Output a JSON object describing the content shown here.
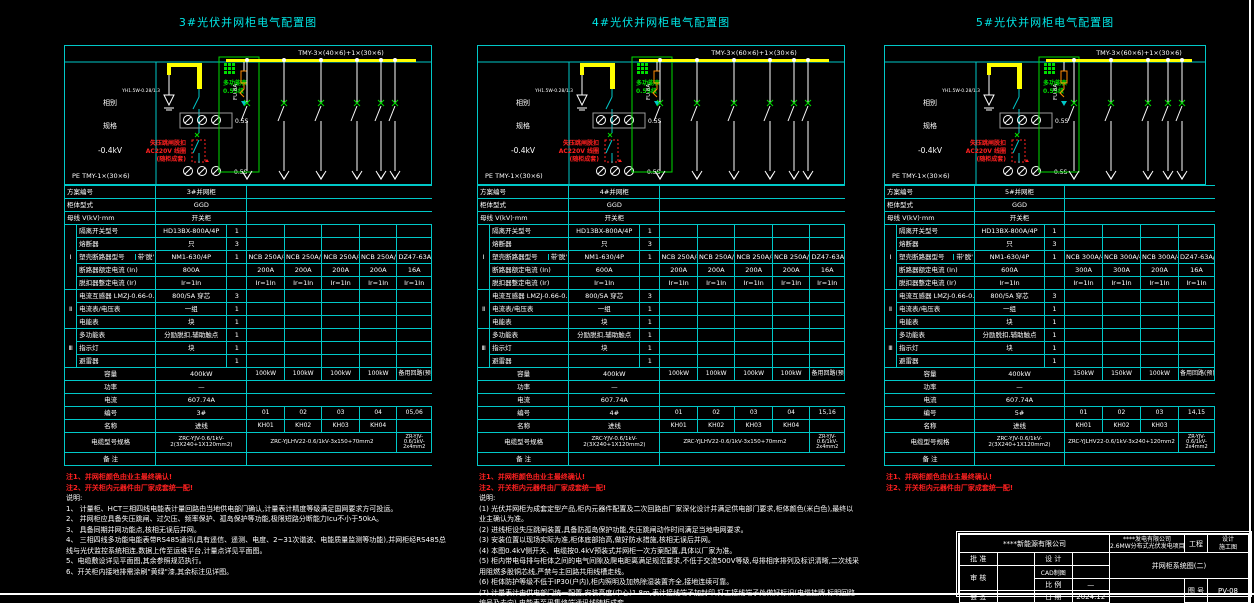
{
  "colors": {
    "cyan": "#00c8c8",
    "white": "#ffffff",
    "yellow": "#ffff00",
    "green": "#00dd00",
    "red": "#ff2020",
    "orange": "#ff8800"
  },
  "panels": [
    {
      "title": "3#光伏并网柜电气配置图",
      "layout": {
        "left": 64,
        "top": 14,
        "width": 368,
        "feeders": 5
      },
      "schematic": {
        "busbar_label": "TMY-3×(40×6)+1×(30×6)",
        "left_label_1": "相别",
        "left_label_2": "规格",
        "voltage_label": "-0.4kV",
        "pe_label": "PE  TMY-1×(30×6)",
        "arrester_label": "YH1.5W-0.28/1.3",
        "meter_class": "0.5S",
        "fuse_label": "FU 8A",
        "green_lines": [
          "多功能表",
          "0.5S级"
        ],
        "red_lines": [
          "失压跳闸脱扣",
          "AC220V 线圈",
          "(随柜成套)"
        ],
        "feeder_xs": [
          183,
          220,
          257,
          293,
          317,
          331
        ],
        "busbar_end": 352
      },
      "header_rows": [
        [
          "方案编号",
          "3#并网柜"
        ],
        [
          "柜体型式",
          "GGD"
        ],
        [
          "母线  V(kV)·mm",
          "开关柜"
        ]
      ],
      "rows": [
        {
          "group": "Ⅰ",
          "span": 5,
          "label": "隔离开关型号",
          "value": "HD13BX-800A/4P",
          "qty": "1",
          "feeders": [
            "",
            "",
            "",
            "",
            ""
          ]
        },
        {
          "label": "熔断器",
          "value": "只",
          "qty": "3",
          "feeders": [
            "",
            "",
            "",
            "",
            ""
          ]
        },
        {
          "label": "塑壳断路器型号",
          "sub": "带'脱'",
          "value": "NM1-630/4P",
          "qty": "1",
          "feeders": [
            "NCB 250A/4P",
            "NCB 250A/4P",
            "NCB 250A/4P",
            "NCB 250A/4P",
            "DZ47-63A/3P"
          ]
        },
        {
          "label": "断路器额定电流 (In)",
          "value": "800A",
          "qty": "",
          "feeders": [
            "200A",
            "200A",
            "200A",
            "200A",
            "16A"
          ]
        },
        {
          "label": "脱扣器整定电流 (Ir)",
          "value": "Ir=1In",
          "qty": "",
          "feeders": [
            "Ir=1In",
            "Ir=1In",
            "Ir=1In",
            "Ir=1In",
            "Ir=1In"
          ]
        },
        {
          "group": "Ⅱ",
          "span": 3,
          "label": "电流互感器  LMZJ-0.66-0.5级",
          "value": "800/5A 穿芯",
          "qty": "3",
          "feeders": [
            "",
            "",
            "",
            "",
            ""
          ]
        },
        {
          "label": "电流表/电压表",
          "value": "一组",
          "qty": "1",
          "feeders": [
            "",
            "",
            "",
            "",
            ""
          ]
        },
        {
          "label": "电能表",
          "value": "块",
          "qty": "1",
          "feeders": [
            "",
            "",
            "",
            "",
            ""
          ]
        },
        {
          "group": "Ⅲ",
          "span": 3,
          "label": "多功能表",
          "value": "分励脱扣,辅助触点",
          "qty": "1",
          "feeders": [
            "",
            "",
            "",
            "",
            ""
          ]
        },
        {
          "label": "指示灯",
          "value": "块",
          "qty": "1",
          "feeders": [
            "",
            "",
            "",
            "",
            ""
          ]
        },
        {
          "label": "避雷器",
          "value": "",
          "qty": "1",
          "feeders": [
            "",
            "",
            "",
            "",
            ""
          ]
        }
      ],
      "summary": {
        "capacity": {
          "label": "容量",
          "value": "400kW",
          "feeders": [
            "100kW",
            "100kW",
            "100kW",
            "100kW",
            "备用回路(预留)"
          ]
        },
        "comp": {
          "label": "功率",
          "value": "—"
        },
        "current": {
          "label": "电流",
          "value": "607.74A"
        },
        "circuit_no": {
          "label": "编号",
          "value": "3#",
          "feeders": [
            "01",
            "02",
            "03",
            "04",
            "05,06"
          ]
        },
        "circuit_name": {
          "label": "名称",
          "value": "进线",
          "feeders": [
            "KH01",
            "KH02",
            "KH03",
            "KH04",
            ""
          ]
        },
        "cable": {
          "label": "电缆型号规格",
          "value": "ZRC-YJV-0.6/1kV-2(3X240+1X120mm2)",
          "span": "ZRC-YJLHV22-0.6/1kV-3x150+70mm2",
          "last": "ZR-YJV-0.6/1kV-2x4mm2"
        },
        "remark": {
          "label": "备 注"
        }
      },
      "notes_red": [
        "注1、并网柜颜色由业主最终确认!",
        "注2、开关柜内元器件由厂家成套统一配!"
      ],
      "notes_title": "说明:",
      "notes": [
        "1、 计量柜、HCT三相四线电能表计量回路由当地供电部门确认,计量表计精度等级满足国网要求方可投运。",
        "2、 并网柜应具备失压跳闸、过欠压、频率保护、孤岛保护等功能,极限短路分断能力Icu不小于50kA。",
        "3、 具备同期并网功能点,核相无误后并网。",
        "4、 三相四线多功能电能表带RS485通讯(具有遥信、遥测、电度、2~31次谐波、电能质量监测等功能),并网柜经RS485总线与光伏监控系统相连,数据上传至运维平台,计量点详见平面图。",
        "5、电缆敷设详见平面图,其余参照规范执行。",
        "6、开关柜内接地排需涂刷\"黄绿\"漆,其余标注见详图。"
      ]
    },
    {
      "title": "4#光伏并网柜电气配置图",
      "layout": {
        "left": 477,
        "top": 14,
        "width": 368,
        "feeders": 5
      },
      "schematic": {
        "busbar_label": "TMY-3×(60×6)+1×(30×6)",
        "left_label_1": "相别",
        "left_label_2": "规格",
        "voltage_label": "-0.4kV",
        "pe_label": "PE  TMY-1×(30×6)",
        "arrester_label": "YH1.5W-0.28/1.3",
        "meter_class": "0.5S",
        "fuse_label": "FU 8A",
        "green_lines": [
          "多功能表",
          "0.5S级"
        ],
        "red_lines": [
          "失压跳闸脱扣",
          "AC220V 线圈",
          "(随柜成套)"
        ],
        "feeder_xs": [
          183,
          220,
          257,
          293,
          317,
          331
        ],
        "busbar_end": 352
      },
      "header_rows": [
        [
          "方案编号",
          "4#并网柜"
        ],
        [
          "柜体型式",
          "GGD"
        ],
        [
          "母线  V(kV)·mm",
          "开关柜"
        ]
      ],
      "rows": [
        {
          "group": "Ⅰ",
          "span": 5,
          "label": "隔离开关型号",
          "value": "HD13BX-800A/4P",
          "qty": "1",
          "feeders": [
            "",
            "",
            "",
            "",
            ""
          ]
        },
        {
          "label": "熔断器",
          "value": "只",
          "qty": "3",
          "feeders": [
            "",
            "",
            "",
            "",
            ""
          ]
        },
        {
          "label": "塑壳断路器型号",
          "sub": "带'脱'",
          "value": "NM1-630/4P",
          "qty": "1",
          "feeders": [
            "NCB 250A/4P",
            "NCB 250A/4P",
            "NCB 250A/4P",
            "NCB 250A/4P",
            "DZ47-63A/3P"
          ]
        },
        {
          "label": "断路器额定电流 (In)",
          "value": "600A",
          "qty": "",
          "feeders": [
            "200A",
            "200A",
            "200A",
            "200A",
            "16A"
          ]
        },
        {
          "label": "脱扣器整定电流 (Ir)",
          "value": "Ir=1In",
          "qty": "",
          "feeders": [
            "Ir=1In",
            "Ir=1In",
            "Ir=1In",
            "Ir=1In",
            "Ir=1In"
          ]
        },
        {
          "group": "Ⅱ",
          "span": 3,
          "label": "电流互感器  LMZJ-0.66-0.5级",
          "value": "800/5A 穿芯",
          "qty": "3",
          "feeders": [
            "",
            "",
            "",
            "",
            ""
          ]
        },
        {
          "label": "电流表/电压表",
          "value": "一组",
          "qty": "1",
          "feeders": [
            "",
            "",
            "",
            "",
            ""
          ]
        },
        {
          "label": "电能表",
          "value": "块",
          "qty": "1",
          "feeders": [
            "",
            "",
            "",
            "",
            ""
          ]
        },
        {
          "group": "Ⅲ",
          "span": 3,
          "label": "多功能表",
          "value": "分励脱扣,辅助触点",
          "qty": "1",
          "feeders": [
            "",
            "",
            "",
            "",
            ""
          ]
        },
        {
          "label": "指示灯",
          "value": "块",
          "qty": "1",
          "feeders": [
            "",
            "",
            "",
            "",
            ""
          ]
        },
        {
          "label": "避雷器",
          "value": "",
          "qty": "1",
          "feeders": [
            "",
            "",
            "",
            "",
            ""
          ]
        }
      ],
      "summary": {
        "capacity": {
          "label": "容量",
          "value": "400kW",
          "feeders": [
            "100kW",
            "100kW",
            "100kW",
            "100kW",
            "备用回路(预留)"
          ]
        },
        "comp": {
          "label": "功率",
          "value": "—"
        },
        "current": {
          "label": "电流",
          "value": "607.74A"
        },
        "circuit_no": {
          "label": "编号",
          "value": "4#",
          "feeders": [
            "01",
            "02",
            "03",
            "04",
            "15,16"
          ]
        },
        "circuit_name": {
          "label": "名称",
          "value": "进线",
          "feeders": [
            "KH01",
            "KH02",
            "KH03",
            "KH04",
            ""
          ]
        },
        "cable": {
          "label": "电缆型号规格",
          "value": "ZRC-YJV-0.6/1kV-2(3X240+1X120mm2)",
          "span": "ZRC-YJLHV22-0.6/1kV-3x150+70mm2",
          "last": "ZR-YJV-0.6/1kV-2x4mm2"
        },
        "remark": {
          "label": "备 注"
        }
      },
      "notes_red": [
        "注1、并网柜颜色由业主最终确认!",
        "注2、开关柜内元器件由厂家成套统一配!"
      ],
      "notes_title": "说明:",
      "notes": [
        "(1) 光伏并网柜为成套定型产品,柜内元器件配置及二次回路由厂家深化设计并满足供电部门要求,柜体颜色(米白色),最终以业主确认为准。",
        "(2) 进线柜设失压跳闸装置,具备防孤岛保护功能,失压跳闸动作时间满足当地电网要求。",
        "(3) 安装位置以现场实际为准,柜体底部抬高,做好防水措施,核相无误后并网。",
        "(4) 本图0.4kV侧开关、电缆按0.4kV预装式并网柜一次方案配置,具体以厂家为准。",
        "(5) 柜内带电母排与柜体之间的电气间隙及爬电距离满足规范要求,不低于交流500V等级,母排相序排列及标识清晰,二次线采用阻燃多股铜芯线,严禁与主回路共用线槽走线。",
        "(6) 柜体防护等级不低于IP30(户内),柜内照明及加热除湿装置齐全,接地连续可靠。",
        "(7) 计量表计由供电部门统一配置,安装高度(中心)1.8m,表计接线端子加封印,打工接线端子处做好标识(电缆挂牌,标明回路编号及去向),电能表至采集终端通讯线随柜成套。",
        "(8) 本图母排选用0.4kV铜母线TMY(规格见图),接至配电室低压0.4kV系统图,编号统一。"
      ]
    },
    {
      "title": "5#光伏并网柜电气配置图",
      "layout": {
        "left": 884,
        "top": 14,
        "width": 322,
        "feeders": 4
      },
      "schematic": {
        "busbar_label": "TMY-3×(60×6)+1×(30×6)",
        "left_label_1": "相别",
        "left_label_2": "规格",
        "voltage_label": "-0.4kV",
        "pe_label": "PE  TMY-1×(30×6)",
        "arrester_label": "YH1.5W-0.28/1.3",
        "meter_class": "0.5S",
        "fuse_label": "FU 8A",
        "green_lines": [
          "多功能表",
          "0.5S级"
        ],
        "red_lines": [
          "失压跳闸脱扣",
          "AC220V 线圈",
          "(随柜成套)"
        ],
        "feeder_xs": [
          190,
          227,
          264,
          284,
          298
        ],
        "busbar_end": 308
      },
      "header_rows": [
        [
          "方案编号",
          "5#并网柜"
        ],
        [
          "柜体型式",
          "GGD"
        ],
        [
          "母线  V(kV)·mm",
          "开关柜"
        ]
      ],
      "rows": [
        {
          "group": "Ⅰ",
          "span": 5,
          "label": "隔离开关型号",
          "value": "HD13BX-800A/4P",
          "qty": "1",
          "feeders": [
            "",
            "",
            "",
            ""
          ]
        },
        {
          "label": "熔断器",
          "value": "只",
          "qty": "3",
          "feeders": [
            "",
            "",
            "",
            ""
          ]
        },
        {
          "label": "塑壳断路器型号",
          "sub": "带'脱'",
          "value": "NM1-630/4P",
          "qty": "1",
          "feeders": [
            "NCB 300A/4P",
            "NCB 300A/4P",
            "NCB 300A/4P",
            "DZ47-63A/3P"
          ]
        },
        {
          "label": "断路器额定电流 (In)",
          "value": "600A",
          "qty": "",
          "feeders": [
            "300A",
            "300A",
            "200A",
            "16A"
          ]
        },
        {
          "label": "脱扣器整定电流 (Ir)",
          "value": "Ir=1In",
          "qty": "",
          "feeders": [
            "Ir=1In",
            "Ir=1In",
            "Ir=1In",
            "Ir=1In"
          ]
        },
        {
          "group": "Ⅱ",
          "span": 3,
          "label": "电流互感器  LMZJ-0.66-0.5级",
          "value": "800/5A 穿芯",
          "qty": "3",
          "feeders": [
            "",
            "",
            "",
            ""
          ]
        },
        {
          "label": "电流表/电压表",
          "value": "一组",
          "qty": "1",
          "feeders": [
            "",
            "",
            "",
            ""
          ]
        },
        {
          "label": "电能表",
          "value": "块",
          "qty": "1",
          "feeders": [
            "",
            "",
            "",
            ""
          ]
        },
        {
          "group": "Ⅲ",
          "span": 3,
          "label": "多功能表",
          "value": "分励脱扣,辅助触点",
          "qty": "1",
          "feeders": [
            "",
            "",
            "",
            ""
          ]
        },
        {
          "label": "指示灯",
          "value": "块",
          "qty": "1",
          "feeders": [
            "",
            "",
            "",
            ""
          ]
        },
        {
          "label": "避雷器",
          "value": "",
          "qty": "1",
          "feeders": [
            "",
            "",
            "",
            ""
          ]
        }
      ],
      "summary": {
        "capacity": {
          "label": "容量",
          "value": "400kW",
          "feeders": [
            "150kW",
            "150kW",
            "100kW",
            "备用回路(预留)"
          ]
        },
        "comp": {
          "label": "功率",
          "value": "—"
        },
        "current": {
          "label": "电流",
          "value": "607.74A"
        },
        "circuit_no": {
          "label": "编号",
          "value": "5#",
          "feeders": [
            "01",
            "02",
            "03",
            "14,15"
          ]
        },
        "circuit_name": {
          "label": "名称",
          "value": "进线",
          "feeders": [
            "KH01",
            "KH02",
            "KH03",
            ""
          ]
        },
        "cable": {
          "label": "电缆型号规格",
          "value": "ZRC-YJV-0.6/1kV-2(3X240+1X120mm2)",
          "span": "ZRC-YJLHV22-0.6/1kV-3x240+120mm2",
          "last": "ZR-YJV-0.6/1kV-2x4mm2"
        },
        "remark": {
          "label": "备 注"
        }
      },
      "notes_red": [
        "注1、并网柜颜色由业主最终确认!",
        "注2、开关柜内元器件由厂家成套统一配!"
      ],
      "notes_title": "",
      "notes": []
    }
  ],
  "titleblock": {
    "company": "****新能源有限公司",
    "project_line1": "****发电有限公司",
    "project_line2": "2.6MW分布式光伏发电项目",
    "project_label": "工程",
    "cat_top": "设计",
    "cat_bottom": "施工图",
    "drawing_title": "并网柜系统图(二)",
    "approve_label": "批 准",
    "design_label": "设 计",
    "check_label": "审 核",
    "cad_label": "CAD制图",
    "scale_label": "比 例",
    "scale_value": "—",
    "sign_label": "会 签",
    "date_label": "日 期",
    "date_value": "2024.12",
    "no_label": "图 号",
    "no_value": "PV-08",
    "page_label": "第 张"
  }
}
